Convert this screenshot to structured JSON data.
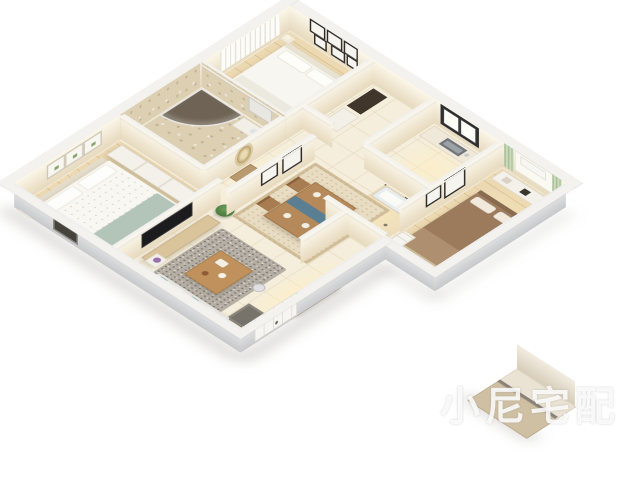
{
  "image_type": "3d-apartment-floorplan-render",
  "background_color": "#ffffff",
  "watermark": {
    "logo": "hexagon-cube-logo",
    "text": "小尼宅配",
    "style": "semi-transparent-white"
  },
  "apartment": {
    "view": "isometric-birdseye",
    "wall_color_interior": "#f7efdd",
    "wall_color_exterior": "#e6e6e8",
    "rooms": [
      {
        "id": "master-bedroom",
        "label": "master bedroom",
        "floor": "light-wood",
        "furniture": [
          "double-bed-white-with-sage-throw",
          "white-sliding-wardrobe",
          "nightstand-with-teal-lamp",
          "three-botanical-wall-frames",
          "dark-exterior-window"
        ]
      },
      {
        "id": "living-room",
        "label": "living room",
        "floor": "cream-tile",
        "furniture": [
          "gray-speckled-rug",
          "wood-coffee-table",
          "tv-cabinet",
          "wall-mounted-tv",
          "gray-sofa-with-teal-pillows",
          "potted-plant",
          "flower-stand",
          "robot-vacuum"
        ]
      },
      {
        "id": "dining-room",
        "label": "dining room",
        "floor": "cream-tile",
        "furniture": [
          "patterned-beige-rug",
          "wood-dining-table-with-blue-runner",
          "four-wood-chairs",
          "two-black-wall-frames"
        ]
      },
      {
        "id": "kitchen",
        "label": "kitchen",
        "floor": "cream-tile",
        "furniture": [
          "l-shaped-counter",
          "double-sink",
          "dark-framed-window"
        ]
      },
      {
        "id": "utility-room",
        "label": "utility room",
        "floor": "cream-tile",
        "furniture": [
          "dark-cabinet",
          "white-cabinet"
        ]
      },
      {
        "id": "guest-bedroom",
        "label": "guest bedroom",
        "floor": "light-wood",
        "furniture": [
          "white-bed",
          "gallery-wall-black-frames",
          "white-curtained-window",
          "nightstand-lamp"
        ]
      },
      {
        "id": "second-bedroom",
        "label": "second bedroom",
        "floor": "light-wood",
        "furniture": [
          "brown-bed",
          "white-desk-shelf-unit",
          "green-curtains",
          "window-with-ac-unit",
          "black-wall-frames",
          "white-drawer-unit",
          "stool"
        ]
      },
      {
        "id": "shower-bathroom",
        "label": "bathroom with shower",
        "floor": "stone-tile",
        "furniture": [
          "curved-glass-shower",
          "white-vanity",
          "toilet"
        ]
      },
      {
        "id": "tub-bathroom",
        "label": "bathroom with tub",
        "floor": "diamond-accent-tile",
        "furniture": [
          "bathtub",
          "toilet"
        ]
      },
      {
        "id": "hallway",
        "label": "hallway",
        "floor": "cream-tile",
        "furniture": [
          "sunburst-mirror",
          "wood-console"
        ]
      },
      {
        "id": "entry-corridor",
        "label": "entry corridor",
        "floor": "cream-tile",
        "furniture": [
          "tall-wood-cabinet",
          "white-panel-door",
          "dark-doormat"
        ]
      }
    ],
    "detached_piece": "small cabinet and wall segment rendered outside lower-right of plan"
  },
  "palette": {
    "floor_tile": "#f5eedd",
    "wood_floor": "#ecd9b2",
    "rug_gray": "#b5afa5",
    "rug_dining": "#e8dcc2",
    "sofa": "#e6e3dd",
    "teal_accent": "#7aa5a3",
    "sage_throw": "#b3c4b8",
    "bed_brown": "#9c7b5c",
    "curtain_green": "#ccdabc",
    "table_wood": "#b5895a",
    "runner_blue": "#5a7e92",
    "cabinet_brown": "#a9875f",
    "frame_dark": "#2b2724",
    "window_dark": "#3b3b3d"
  }
}
